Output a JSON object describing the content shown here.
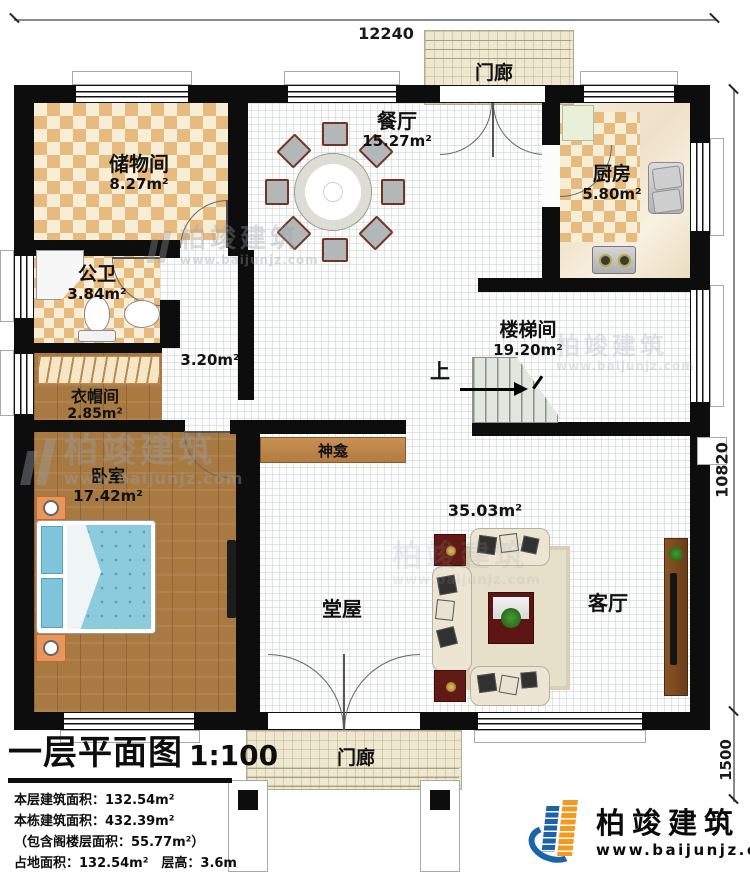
{
  "dimensions": {
    "top": "12240",
    "right": "10820",
    "porch": "1500"
  },
  "rooms": {
    "storage": {
      "name": "储物间",
      "area": "8.27m²"
    },
    "dining": {
      "name": "餐厅",
      "area": "15.27m²"
    },
    "kitchen": {
      "name": "厨房",
      "area": "5.80m²"
    },
    "bathroom": {
      "name": "公卫",
      "area": "3.84m²"
    },
    "corridor": {
      "area": "3.20m²"
    },
    "stairwell": {
      "name": "楼梯间",
      "area": "19.20m²",
      "up_label": "上"
    },
    "cloakroom": {
      "name": "衣帽间",
      "area": "2.85m²"
    },
    "bedroom": {
      "name": "卧室",
      "area": "17.42m²"
    },
    "shrine": {
      "name": "神龛"
    },
    "main_hall": {
      "name": "堂屋",
      "area": "35.03m²"
    },
    "living": {
      "name": "客厅"
    },
    "porch_top": {
      "name": "门廊"
    },
    "porch_bottom": {
      "name": "门廊"
    }
  },
  "title_block": {
    "title": "一层平面图",
    "scale": "1:100",
    "lines": [
      "本层建筑面积：132.54m²",
      "本栋建筑面积：432.39m²",
      "（包含阁楼层面积：55.77m²）",
      "占地面积：132.54m²　层高：3.6m"
    ]
  },
  "brand": {
    "name": "柏竣建筑",
    "website": "www.baijunjz.com"
  },
  "watermark": {
    "name": "柏竣建筑",
    "website": "www.baijunjz.com"
  },
  "colors": {
    "wall": "#0d0d0d",
    "logo_blue": "#1b63ab",
    "logo_orange": "#f5991f"
  }
}
